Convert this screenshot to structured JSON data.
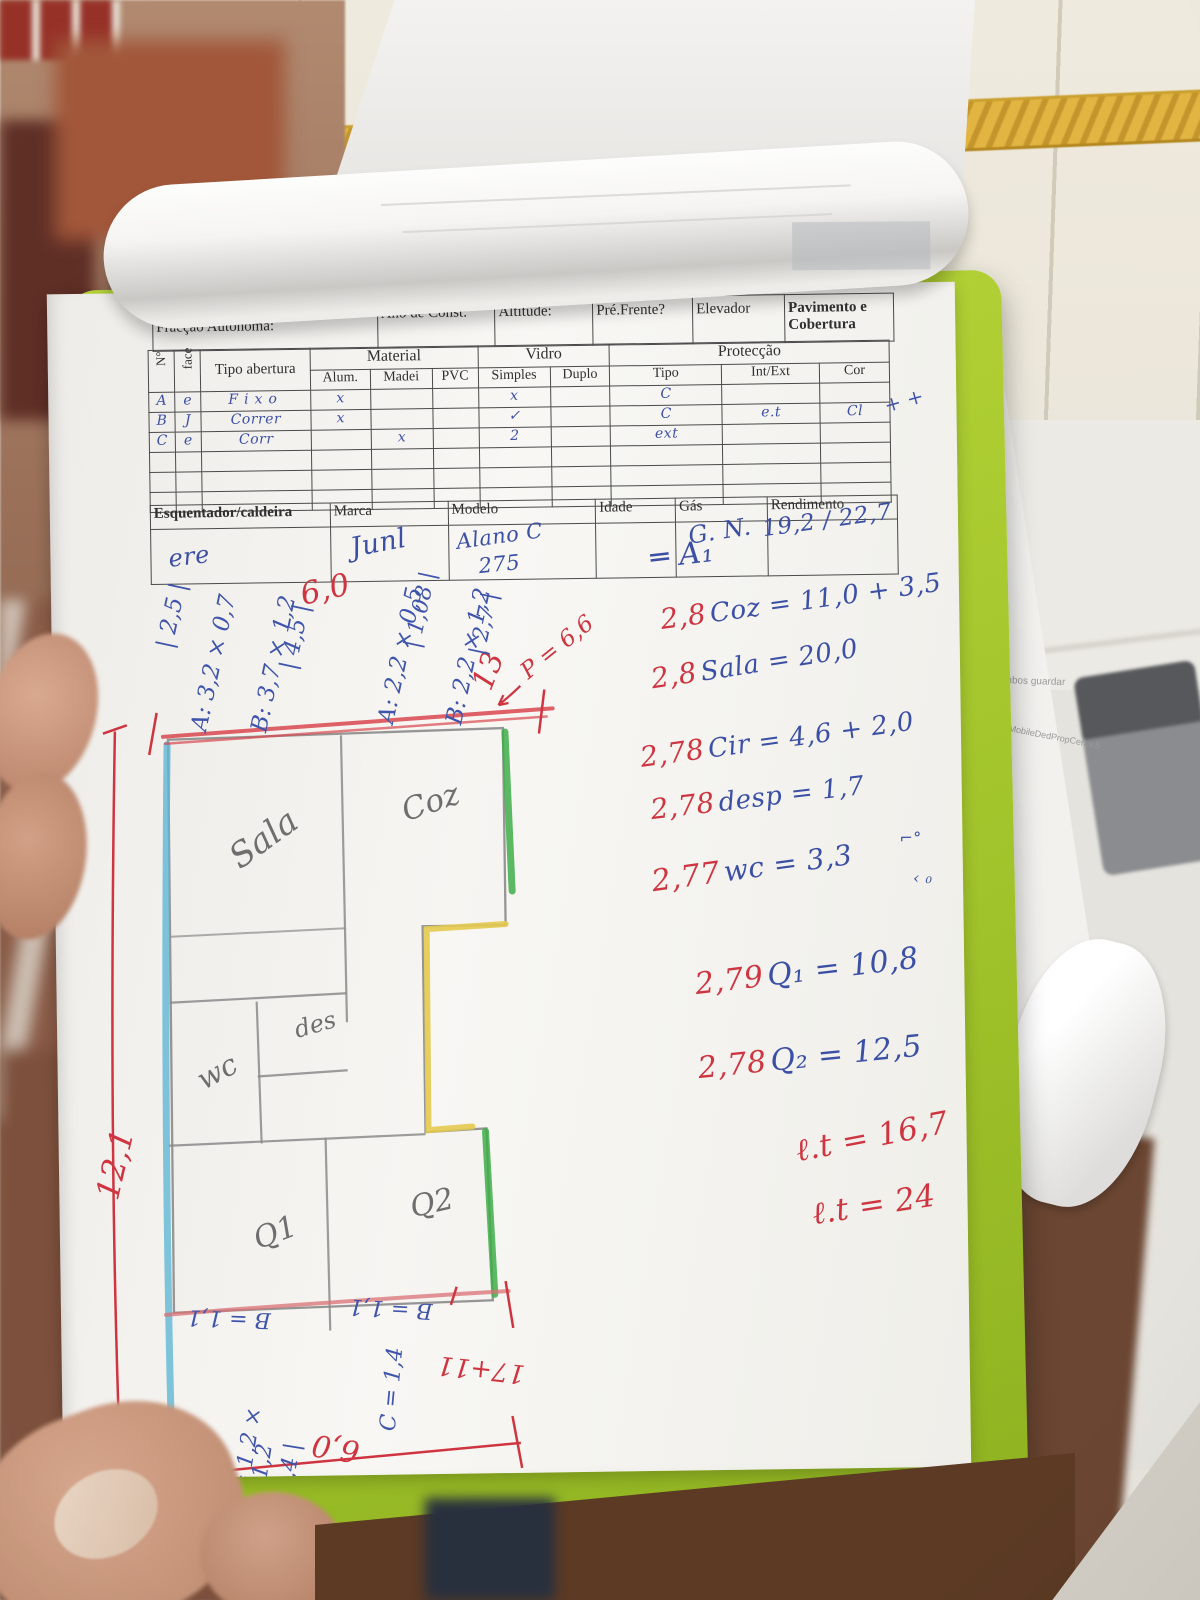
{
  "form": {
    "scribble_title": "Brecah O Longo",
    "fraccao": "Fracção Autónoma:",
    "ano": "Ano de Const:",
    "altitude": "Altitude:",
    "pre_frente": "Pré.Frente?",
    "elevador": "Elevador",
    "pavimento": "Pavimento e Cobertura",
    "openings": {
      "num": "N°",
      "face": "face",
      "tipo_abertura": "Tipo abertura",
      "material": "Material",
      "alum": "Alum.",
      "madei": "Madei",
      "pvc": "PVC",
      "vidro": "Vidro",
      "simples": "Simples",
      "duplo": "Duplo",
      "proteccao": "Protecção",
      "tipo": "Tipo",
      "int_ext": "Int/Ext",
      "cor": "Cor",
      "rows": [
        {
          "n": "A",
          "face": "e",
          "tipo": "Fixo",
          "alum": "x",
          "madei": "",
          "pvc": "",
          "simples": "x",
          "duplo": "",
          "ptipo": "C",
          "intext": "",
          "cor": ""
        },
        {
          "n": "B",
          "face": "J",
          "tipo": "Correr",
          "alum": "x",
          "madei": "",
          "pvc": "",
          "simples": "✓",
          "duplo": "",
          "ptipo": "C",
          "intext": "e.t",
          "cor": "Cl"
        },
        {
          "n": "C",
          "face": "e",
          "tipo": "Corr",
          "alum": "",
          "madei": "x",
          "pvc": "",
          "simples": "2",
          "duplo": "",
          "ptipo": "ext",
          "intext": "",
          "cor": ""
        }
      ],
      "margin_marks": "+ +"
    },
    "heater": {
      "label": "Esquentador/caldeira",
      "marca": "Marca",
      "modelo": "Modelo",
      "idade": "Idade",
      "gas": "Gás",
      "rendimento": "Rendimento",
      "v_label": "ere",
      "v_marca": "Junl",
      "v_modelo1": "Alano C",
      "v_modelo2": "275",
      "v_gas": "G. N.",
      "v_rend": "19,2 / 22,7"
    }
  },
  "sketch": {
    "dim_top": "6,0",
    "dim_top_total": "13",
    "dim_perimeter": "P = 6,6",
    "dim_left": "12,1",
    "m1": "A: 3,2 × 0,7",
    "m1_total": "| 2,5 |",
    "m2": "B: 3,7 × 1,2",
    "m2_total": "| 4,5 |",
    "m3": "A: 2,2 × 0,5",
    "m3_total": "| 1,08 |",
    "m4": "B: 2,2 × 1,2",
    "m4_total": "| 2,7 |",
    "room_sala": "Sala",
    "room_coz": "Coz",
    "room_wc": "wc",
    "room_des": "des",
    "room_q1": "Q1",
    "room_q2": "Q2",
    "dim_b1": "B = 1,1",
    "dim_b2": "B = 1,1",
    "dim_c": "C = 1,4",
    "dim_a_bottom": "A = 1,2 ×",
    "dim_a_bottom2": "1,2",
    "dim_a_total": "| 1,4 |",
    "dim_bottom_sum": "17+11",
    "dim_bottom": "6,0"
  },
  "calc": {
    "header": "═ A₁",
    "lines": [
      {
        "h": "2,8",
        "t": "Coz = 11,0 + 3,5"
      },
      {
        "h": "2,8",
        "t": "Sala = 20,0"
      },
      {
        "h": "2,78",
        "t": "Cir = 4,6 + 2,0"
      },
      {
        "h": "2,78",
        "t": "desp = 1,7"
      },
      {
        "h": "2,77",
        "t": "wc = 3,3"
      },
      {
        "h": "2,79",
        "t": "Q₁ = 10,8"
      },
      {
        "h": "2,78",
        "t": "Q₂ = 12,5"
      }
    ],
    "wc_mark_1": "⌐°",
    "wc_mark_2": "‹ ₀",
    "total_1": "ℓ.t = 16,7",
    "total_2": "ℓ.t = 24"
  },
  "side_paper": {
    "mark_1": "3",
    "mark_2": "3o",
    "note_1": "ambos guardar",
    "note_2": "MobileDedPropCert.v.5"
  },
  "colors": {
    "clipboard_green": "#a3c52c",
    "pen_blue": "#3b4fa5",
    "pen_red": "#cf3540",
    "crayon_red": "#d8474e",
    "crayon_cyan": "#5fb7d4",
    "crayon_green": "#3fae4a",
    "crayon_yellow": "#e3c94f",
    "pencil": "#8b8b8b",
    "gold_tile": "#d9a93c"
  }
}
